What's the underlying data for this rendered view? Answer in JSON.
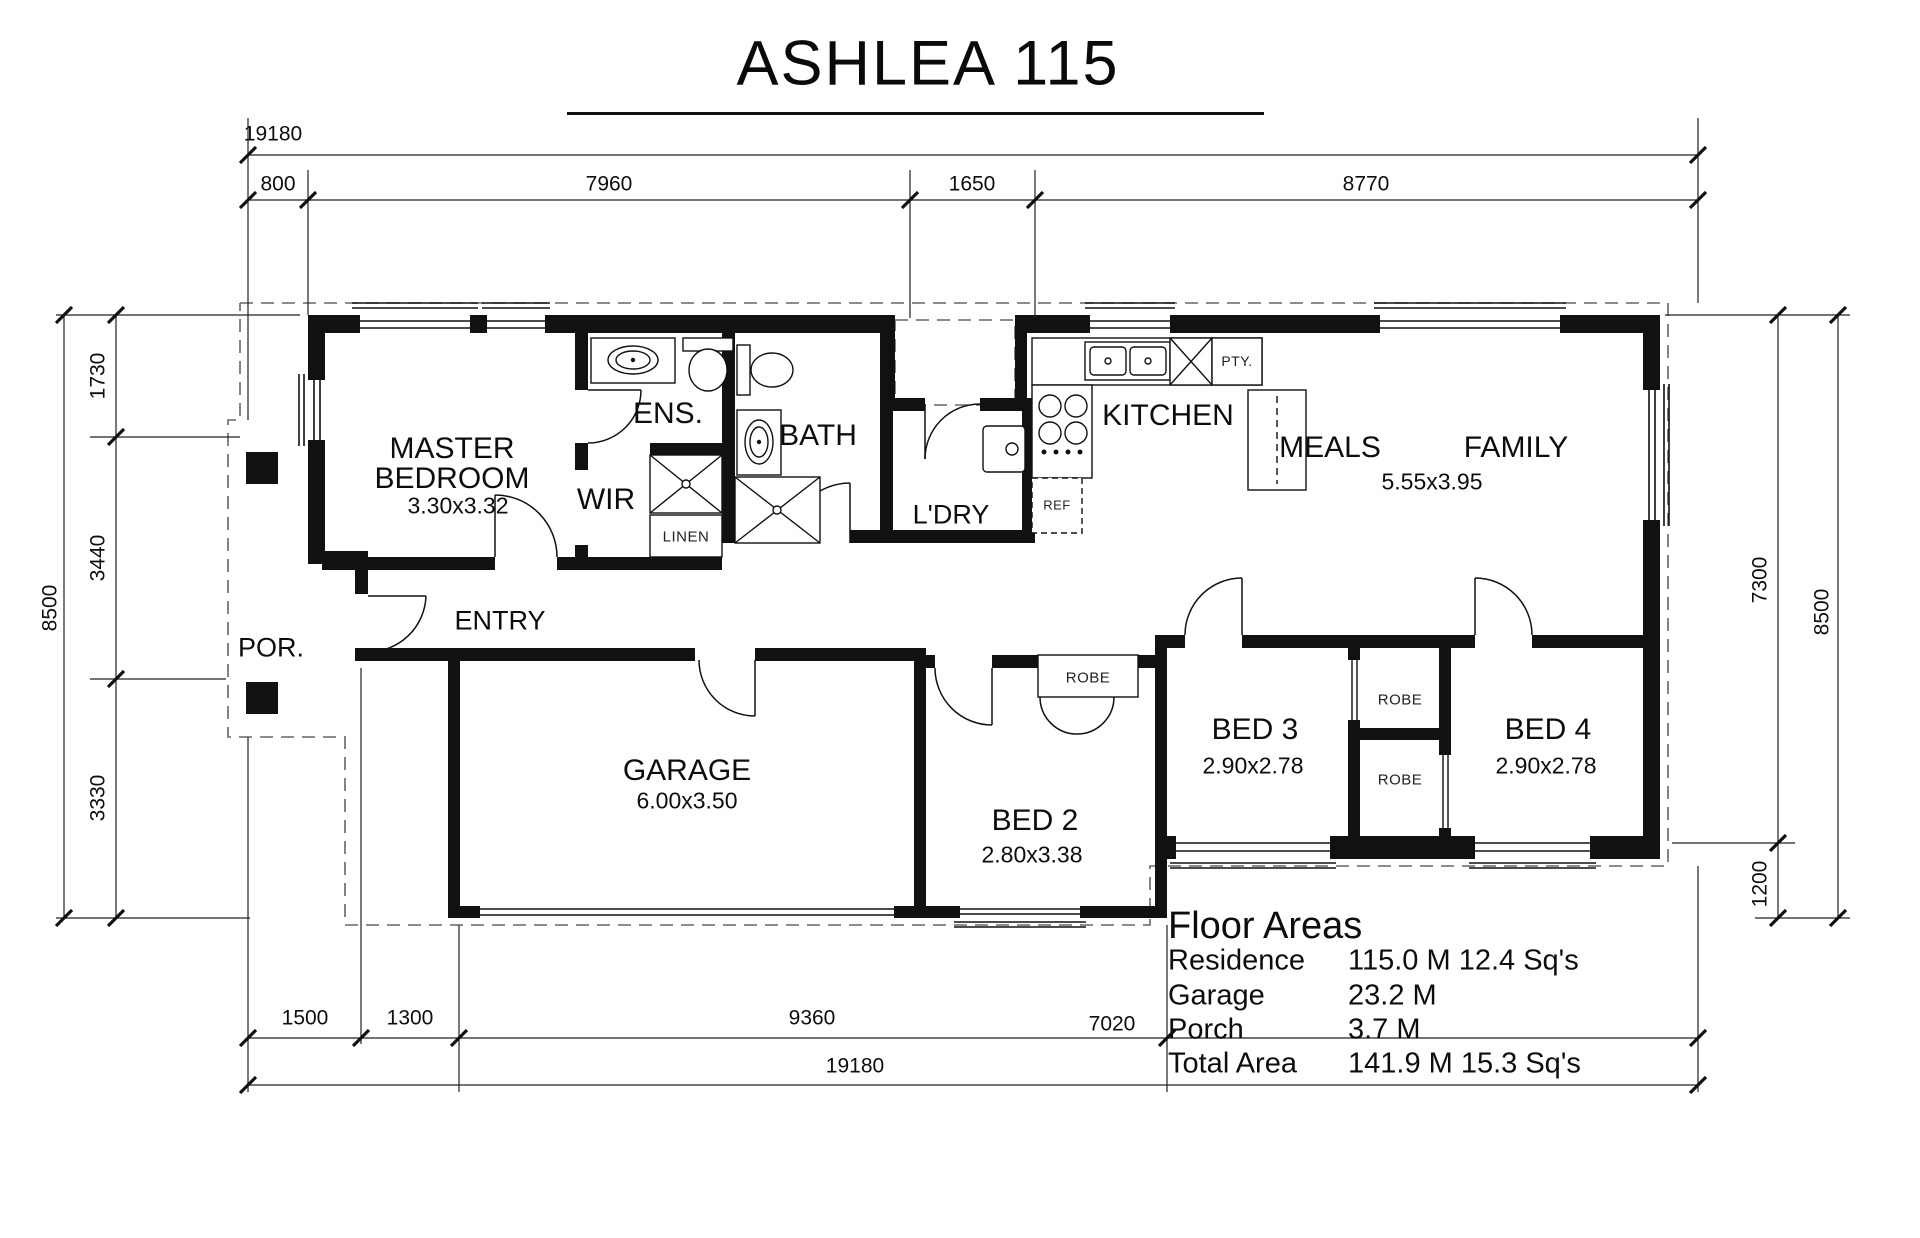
{
  "title": "ASHLEA 115",
  "dims": {
    "top": [
      "19180",
      "800",
      "7960",
      "1650",
      "8770"
    ],
    "left": [
      "8500",
      "1730",
      "3440",
      "3330"
    ],
    "right": [
      "7300",
      "8500",
      "1200"
    ],
    "bottom": [
      "1500",
      "1300",
      "9360",
      "7020",
      "19180"
    ]
  },
  "rooms": {
    "master": {
      "line1": "MASTER",
      "line2": "BEDROOM",
      "size": "3.30x3.32"
    },
    "ens": "ENS.",
    "wir": "WIR",
    "linen": "LINEN",
    "bath": "BATH",
    "ldry": "L'DRY",
    "kitchen": "KITCHEN",
    "pty": "PTY.",
    "ref": "REF",
    "meals": "MEALS",
    "family": "FAMILY",
    "meals_family_size": "5.55x3.95",
    "porch": "POR.",
    "entry": "ENTRY",
    "garage": {
      "name": "GARAGE",
      "size": "6.00x3.50"
    },
    "bed2": {
      "name": "BED 2",
      "size": "2.80x3.38"
    },
    "bed3": {
      "name": "BED 3",
      "size": "2.90x2.78"
    },
    "bed4": {
      "name": "BED 4",
      "size": "2.90x2.78"
    },
    "robe": "ROBE"
  },
  "floor_areas": {
    "heading": "Floor Areas",
    "rows": [
      {
        "label": "Residence",
        "value": "115.0 M 12.4 Sq's"
      },
      {
        "label": "Garage",
        "value": "23.2 M"
      },
      {
        "label": "Porch",
        "value": "3.7 M"
      },
      {
        "label": "Total Area",
        "value": "141.9 M 15.3 Sq's"
      }
    ]
  },
  "colors": {
    "wall": "#111111",
    "thin_line": "#222222",
    "dashed_eave": "#666666",
    "text": "#0d0d0d",
    "background": "#ffffff"
  }
}
